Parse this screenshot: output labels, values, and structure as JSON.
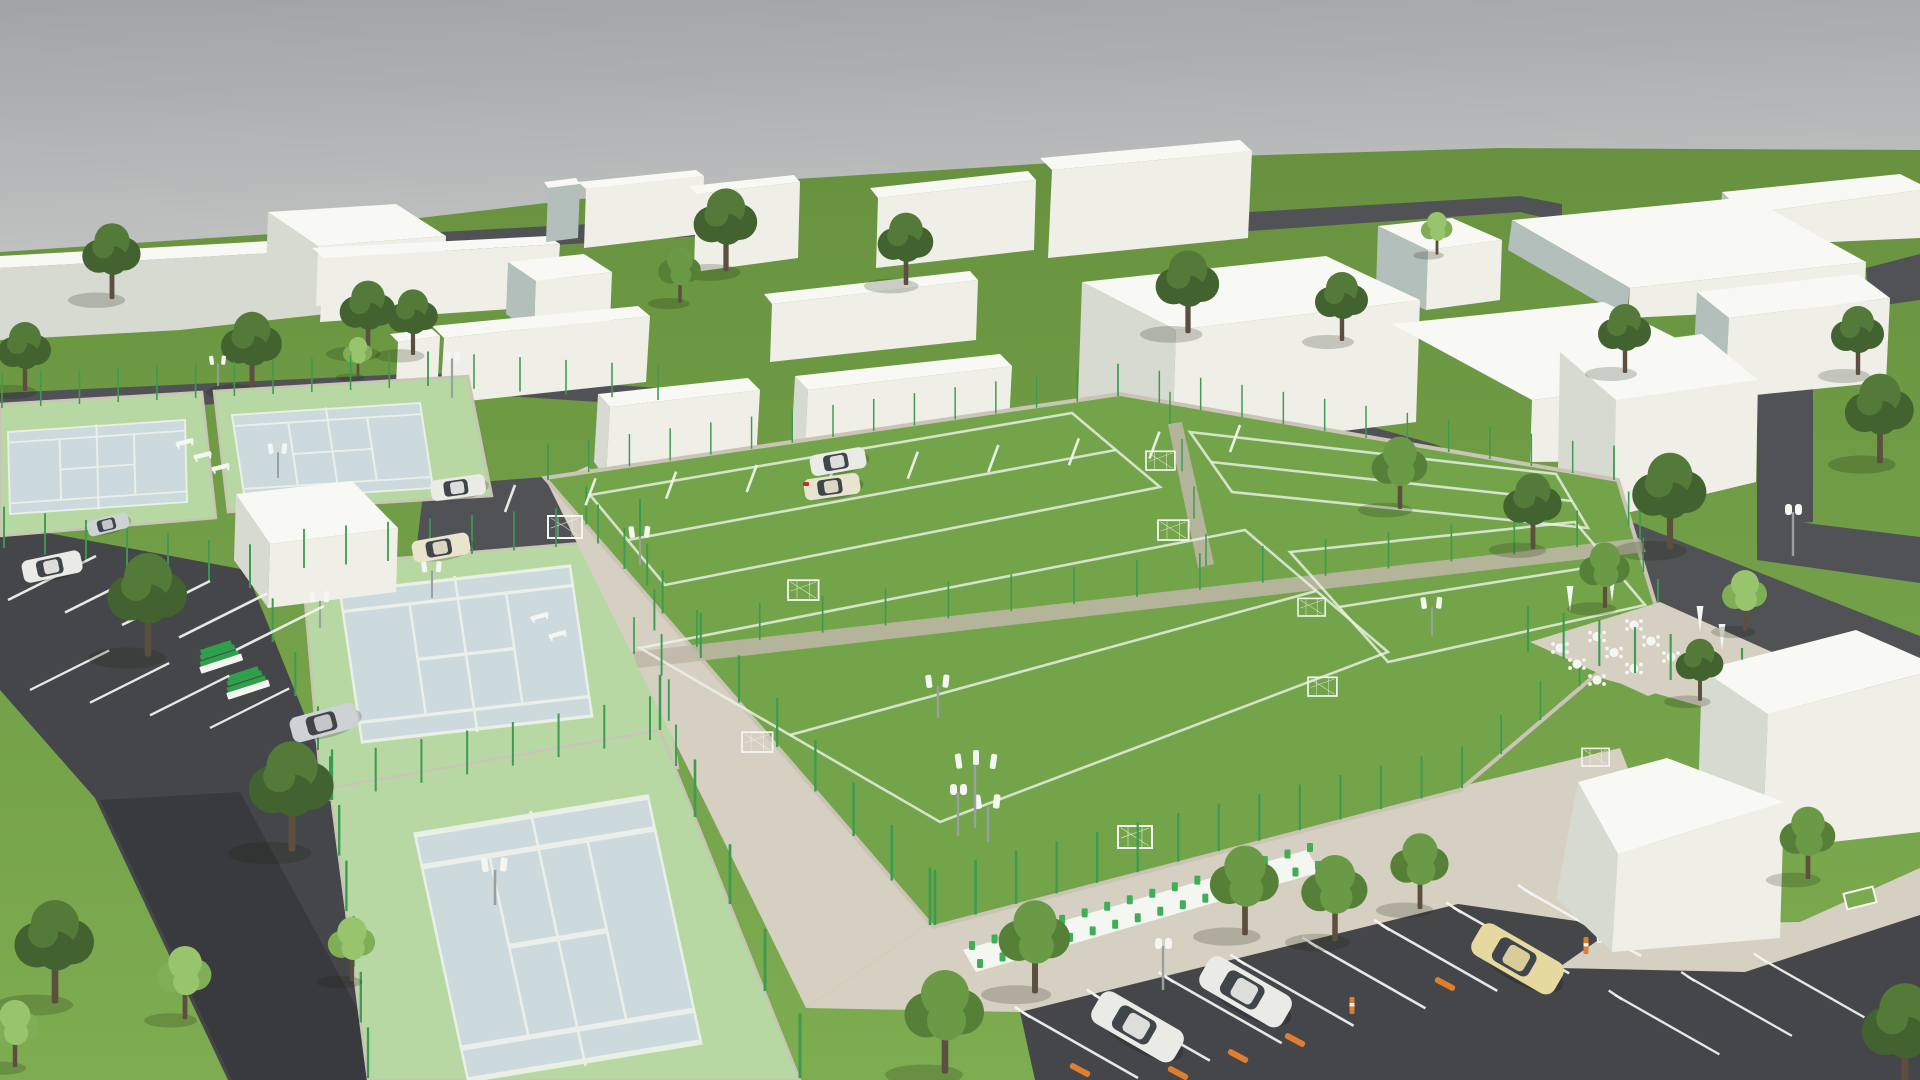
{
  "title": "Aerial 3D architectural rendering of a sports complex",
  "scene": {
    "type": "3d-render",
    "view": "high-angle aerial",
    "inventory": {
      "tennis_courts": 4,
      "soccer_fields": 4,
      "soccer_goals": 9,
      "floodlights": 9,
      "streetlights": 4,
      "parking_lots": 2,
      "cars": 10,
      "cafe_tables": 9,
      "umbrellas": 4,
      "bleacher_units": 2,
      "benches": 7,
      "spectator_seat_row_sections": 2,
      "background_buildings": 22,
      "trees": 34,
      "orange_wheel_stops": 5,
      "orange_bollards": 2,
      "perimeter_fence": "green posts around all courts and pitches"
    },
    "areas": {
      "left": "two small tennis courts, clubhouse cube, two large tennis courts, parking lot with cars",
      "center": "four fenced artificial-turf soccer pitches with white markings and goals",
      "right": "road, café terrace with white tables, large white model buildings",
      "bottom": "paver esplanade, green spectator seating, parking lot with white stall lines, cars and orange wheel stops",
      "top": "white massing-model buildings on lawns with dark access roads and trees"
    }
  },
  "colors": {
    "sky1": "#a4a5a8",
    "sky2": "#c9cac9",
    "grassFar": "#68913f",
    "grassNear": "#7cab4f",
    "turf": "#73a44a",
    "turfLine": "#edf2ea",
    "courtBlue": "#ccd9dd",
    "apron": "#b7d8a3",
    "roadA": "#515256",
    "roadB": "#45464a",
    "roadC": "#393a3d",
    "curb": "#c9c4b6",
    "paver": "#d6d0c3",
    "paverD": "#beb7a7",
    "bTop": "#f8f9f4",
    "bFront": "#efefe7",
    "bSide": "#d7dad0",
    "bCool": "#b2bfba",
    "bCyan": "#a2b7b6",
    "fence": "#3c9b50",
    "treeD1": "#42622f",
    "treeD2": "#547a39",
    "treeM1": "#567f38",
    "treeM2": "#6b9a46",
    "treeL1": "#7fae57",
    "treeL2": "#97c46c",
    "trunk": "#5d4f3f",
    "white": "#f4f6f2",
    "seatG": "#3fae57",
    "bleachG": "#2ea14b",
    "carWhite": "#eaebe7",
    "carSilver": "#ced2d4",
    "carCream": "#e9e4cd",
    "carYellow": "#e5d99f",
    "glass": "#3f454b",
    "tail": "#c23128",
    "orange": "#dd7f2f",
    "poleGray": "#9aa09e",
    "shadow": "rgba(20,30,12,0.20)"
  }
}
